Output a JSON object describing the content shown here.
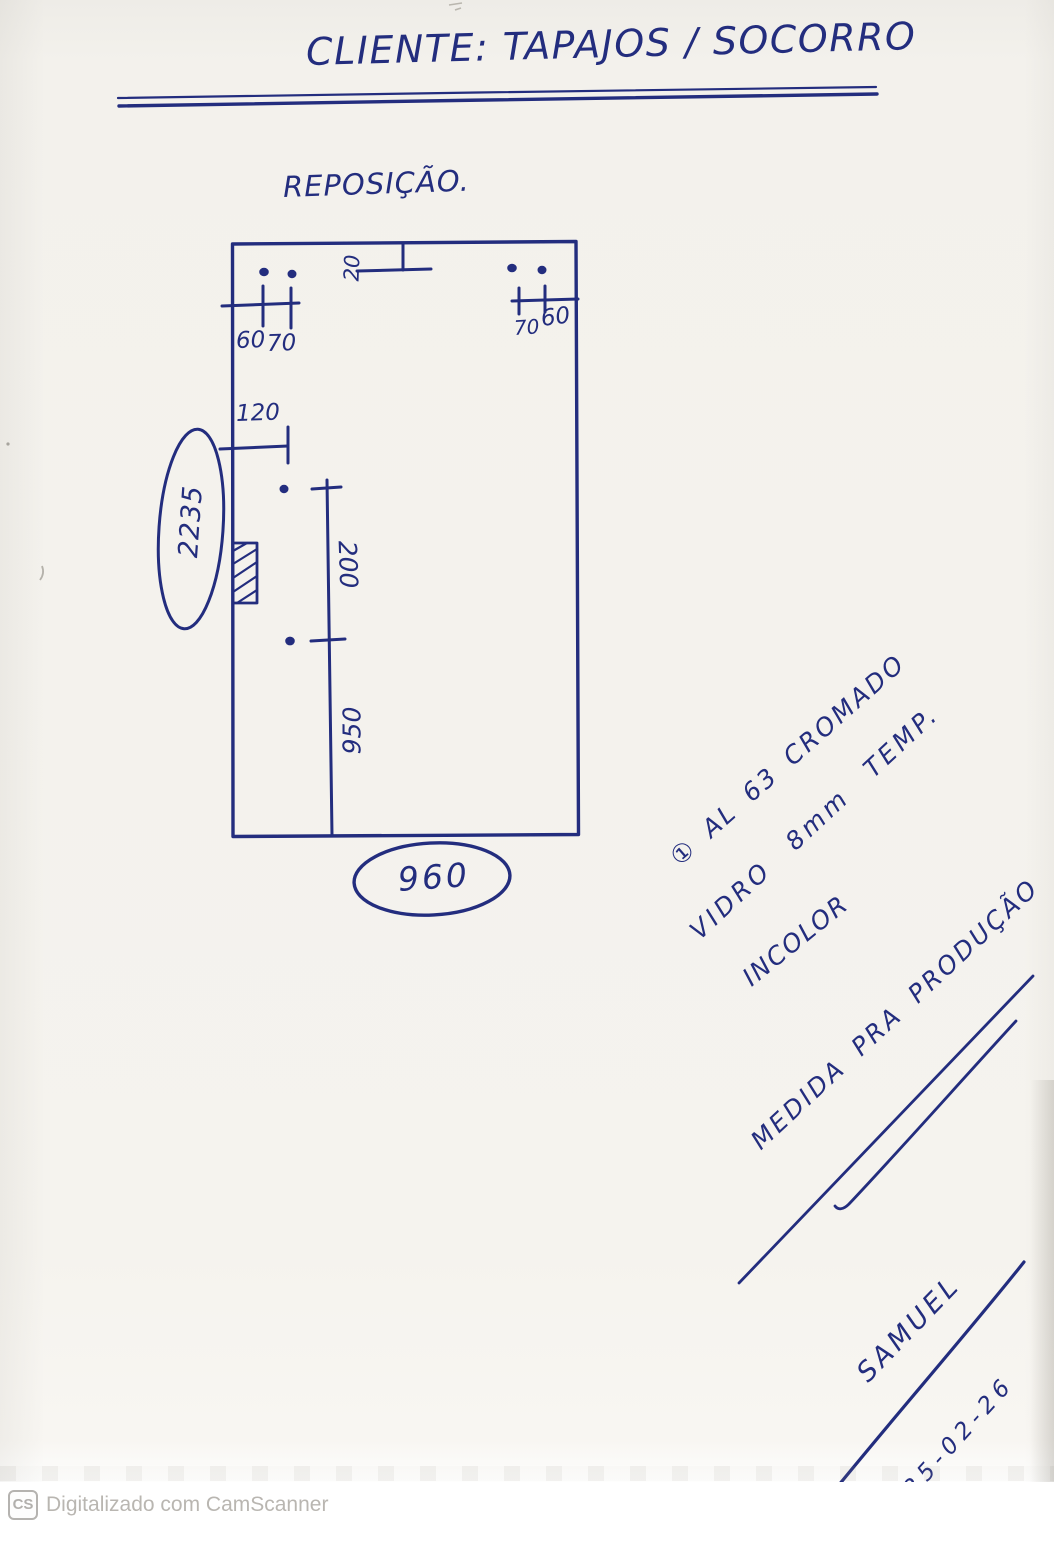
{
  "header": {
    "title": "CLIENTE: TAPAJOS / SOCORRO"
  },
  "drawing": {
    "label": "REPOSIÇÃO.",
    "dims": {
      "top_left_first": "60",
      "top_left_second": "70",
      "top_right_first": "70",
      "top_right_second": "60",
      "top_center_offset": "20",
      "left_offset": "120",
      "hole_spacing": "200",
      "bottom_span": "950",
      "width_total": "960",
      "height_total": "2235"
    }
  },
  "notes": {
    "line1": "① AL 63 CROMADO",
    "line2": "VIDRO 8mm TEMP.",
    "line3": "INCOLOR",
    "line4": "MEDIDA PRA PRODUÇÃO"
  },
  "signature": {
    "name": "SAMUEL",
    "date": "25-02-26"
  },
  "watermark": {
    "badge": "CS",
    "text": "Digitalizado com CamScanner"
  },
  "colors": {
    "ink": "#232d7e",
    "paper": "#f4f2ec",
    "watermark_gray": "#b9b6b1"
  }
}
